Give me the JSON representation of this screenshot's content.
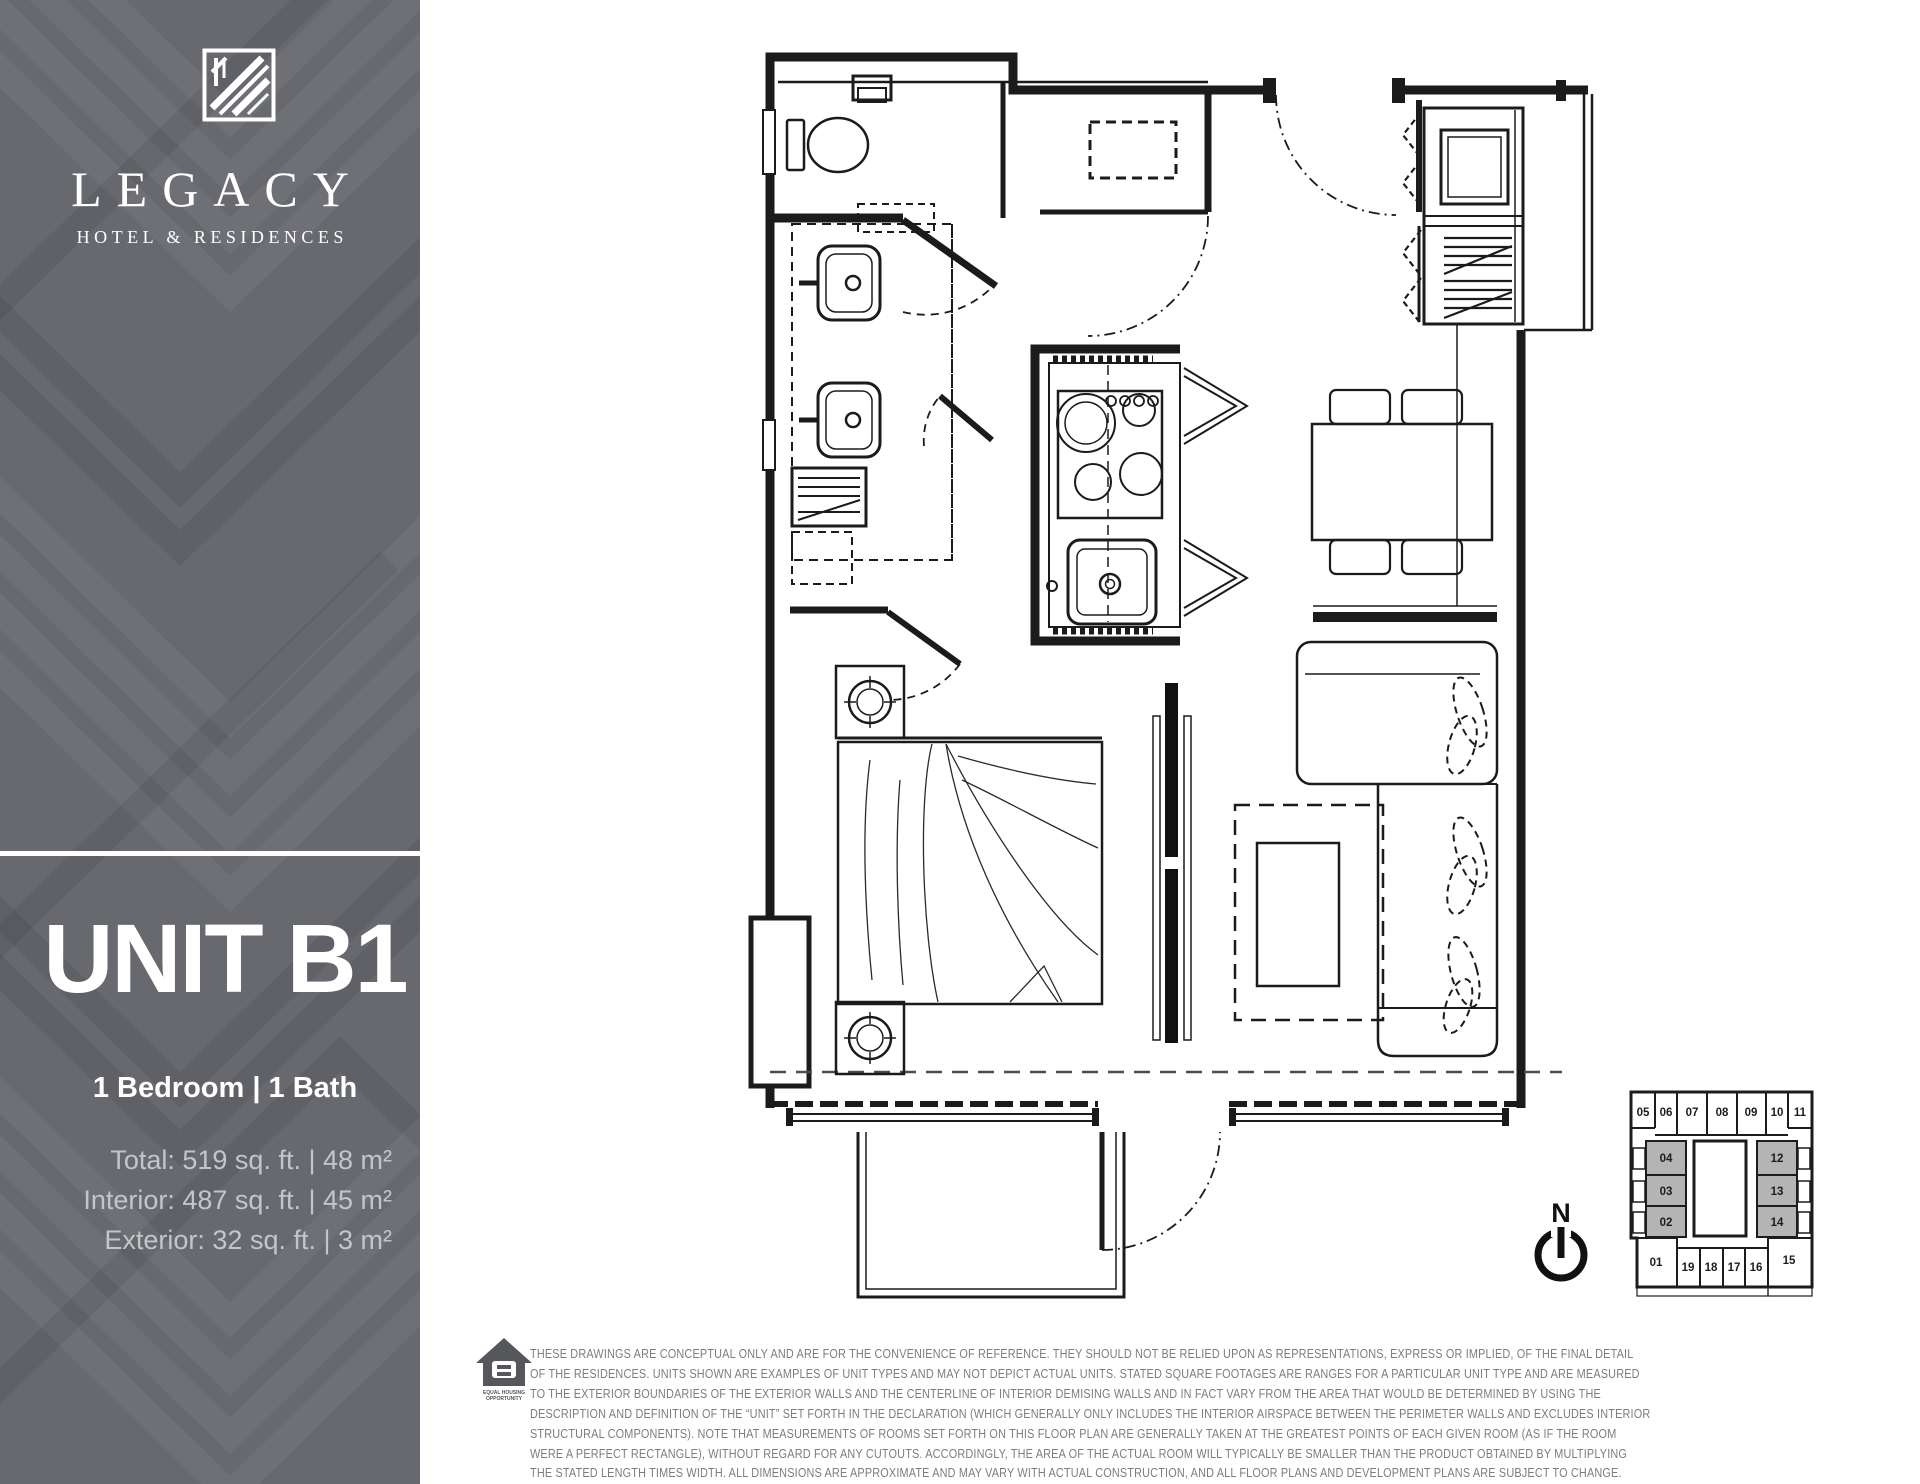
{
  "sidebar": {
    "bg_color": "#67696f",
    "brand": {
      "logo_icon": "legacy-monogram-icon",
      "name": "LEGACY",
      "tagline": "HOTEL & RESIDENCES"
    },
    "unit": {
      "title": "UNIT B1",
      "config": "1 Bedroom | 1 Bath"
    },
    "stats_lines": [
      "Total: 519 sq. ft. | 48 m²",
      "Interior: 487 sq. ft. | 45 m²",
      "Exterior: 32 sq. ft. | 3 m²"
    ]
  },
  "floor_plan": {
    "line_color": "#1b1b1b",
    "features": [
      "bathroom",
      "vanity-sinks",
      "linen-closet",
      "entry-closet",
      "laundry-closet",
      "kitchen-island",
      "dining-table",
      "bedroom-bed",
      "nightstands",
      "sliding-partition",
      "sectional-sofa",
      "coffee-table",
      "rug",
      "balcony"
    ]
  },
  "key_plan": {
    "highlight_color": "#b4b4b4",
    "top_row": [
      "05",
      "06",
      "07",
      "08",
      "09",
      "10",
      "11"
    ],
    "left_column": [
      "04",
      "03",
      "02"
    ],
    "right_column": [
      "12",
      "13",
      "14"
    ],
    "bottom_row": [
      "01",
      "19",
      "18",
      "17",
      "16",
      "15"
    ],
    "highlighted": [
      "04",
      "03",
      "02",
      "12",
      "13",
      "14"
    ]
  },
  "compass": {
    "label": "N"
  },
  "footer": {
    "eho": {
      "line1": "EQUAL HOUSING",
      "line2": "OPPORTUNITY"
    },
    "disclaimer": [
      "THESE DRAWINGS ARE CONCEPTUAL ONLY AND ARE FOR THE CONVENIENCE OF REFERENCE. THEY SHOULD NOT BE RELIED UPON AS REPRESENTATIONS, EXPRESS OR IMPLIED, OF THE FINAL DETAIL",
      "OF THE RESIDENCES. UNITS SHOWN ARE EXAMPLES OF UNIT TYPES AND MAY NOT DEPICT ACTUAL UNITS. STATED SQUARE FOOTAGES ARE RANGES FOR A PARTICULAR UNIT TYPE AND ARE MEASURED",
      "TO THE EXTERIOR BOUNDARIES OF THE EXTERIOR WALLS AND THE CENTERLINE OF INTERIOR DEMISING WALLS AND IN FACT VARY FROM THE AREA THAT WOULD BE DETERMINED BY USING THE",
      "DESCRIPTION AND DEFINITION OF THE “UNIT” SET FORTH IN THE DECLARATION (WHICH GENERALLY ONLY INCLUDES THE INTERIOR AIRSPACE BETWEEN THE PERIMETER WALLS AND EXCLUDES INTERIOR",
      "STRUCTURAL COMPONENTS). NOTE THAT MEASUREMENTS OF ROOMS SET FORTH ON THIS FLOOR PLAN ARE GENERALLY TAKEN AT THE GREATEST POINTS OF EACH GIVEN ROOM (AS IF THE ROOM",
      "WERE A PERFECT RECTANGLE), WITHOUT REGARD FOR ANY CUTOUTS.  ACCORDINGLY, THE AREA OF THE ACTUAL ROOM WILL TYPICALLY BE SMALLER THAN THE PRODUCT OBTAINED BY MULTIPLYING",
      "THE STATED LENGTH TIMES WIDTH.  ALL DIMENSIONS ARE APPROXIMATE AND MAY VARY WITH ACTUAL CONSTRUCTION, AND ALL FLOOR PLANS AND DEVELOPMENT PLANS ARE SUBJECT TO CHANGE."
    ]
  }
}
